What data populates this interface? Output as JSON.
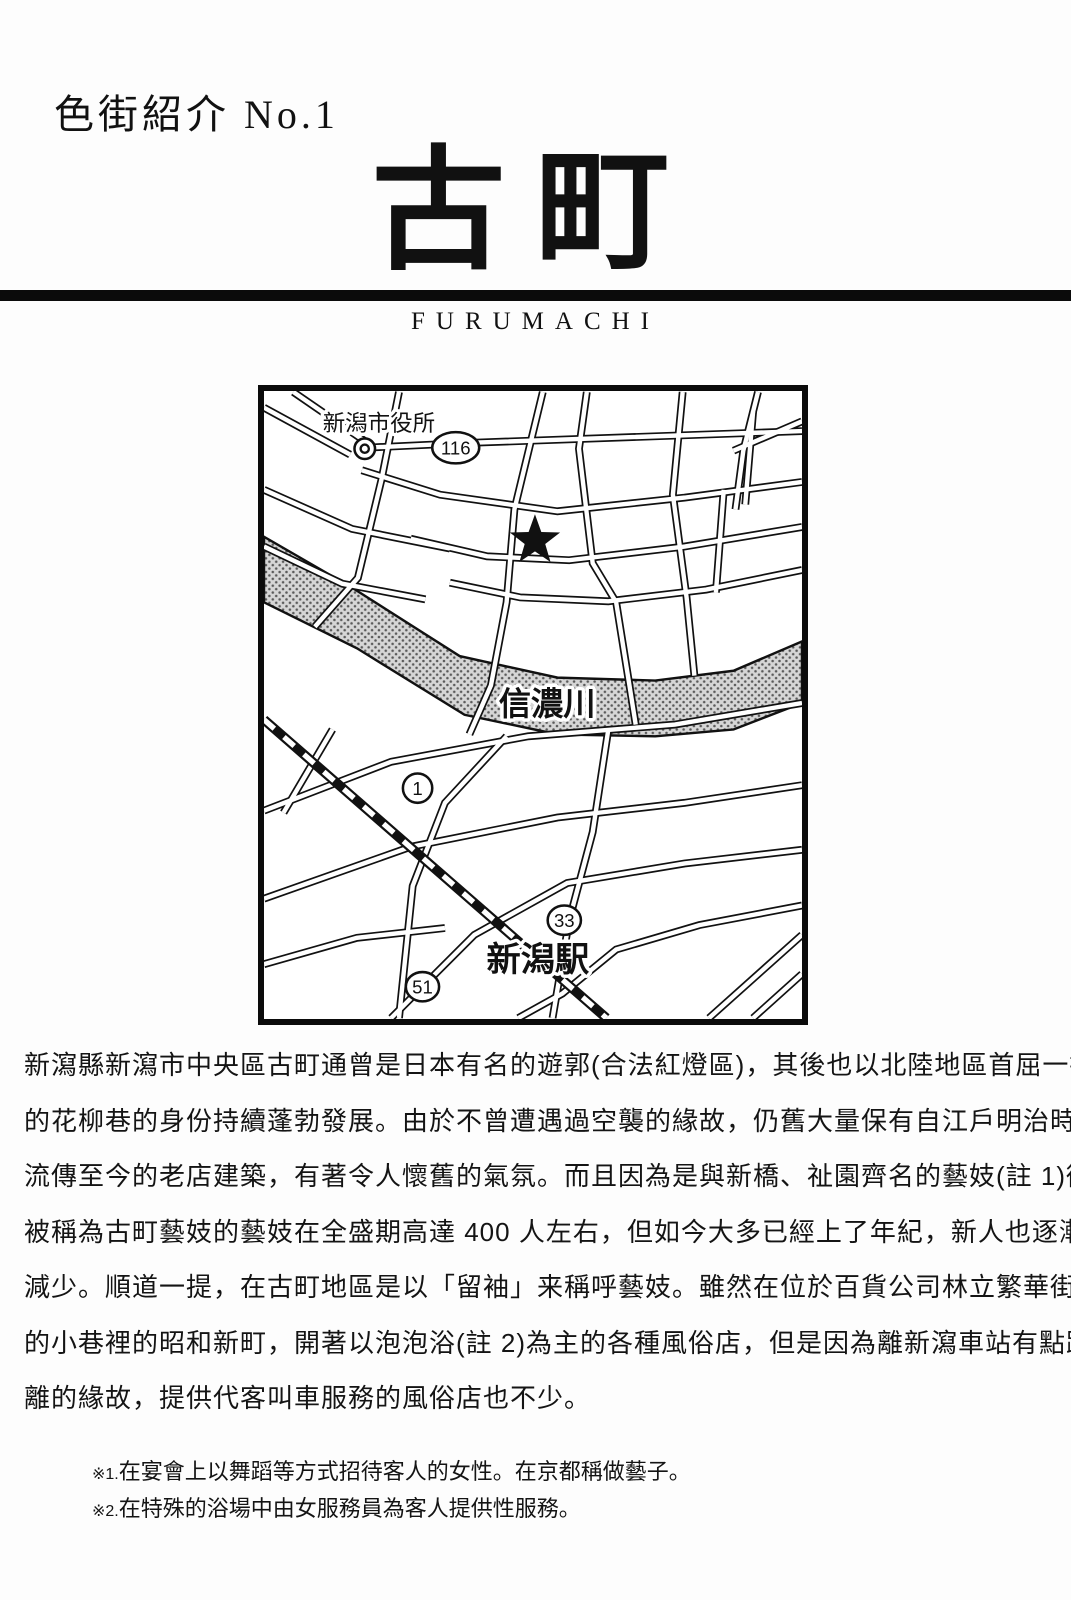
{
  "page": {
    "series_label": "色街紹介 No.1",
    "title": "古町",
    "title_romaji": "FURUMACHI"
  },
  "map": {
    "labels": {
      "city_hall": "新潟市役所",
      "river": "信濃川",
      "station": "新潟駅"
    },
    "badges": [
      {
        "number": "116"
      },
      {
        "number": "1"
      },
      {
        "number": "33"
      },
      {
        "number": "51"
      }
    ],
    "marker": "star"
  },
  "body": {
    "lines": [
      "新瀉縣新瀉市中央區古町通曾是日本有名的遊郭(合法紅燈區)，其後也以北陸地區首屈一指",
      "的花柳巷的身份持續蓬勃發展。由於不曾遭遇過空襲的緣故，仍舊大量保有自江戶明治時代",
      "流傳至今的老店建築，有著令人懷舊的氣氛。而且因為是與新橋、祉園齊名的藝妓(註 1)街，",
      "被稱為古町藝妓的藝妓在全盛期高達 400 人左右，但如今大多已經上了年紀，新人也逐漸",
      "減少。順道一提，在古町地區是以「留袖」来稱呼藝妓。雖然在位於百貨公司林立繁華街道",
      "的小巷裡的昭和新町，開著以泡泡浴(註 2)為主的各種風俗店，但是因為離新瀉車站有點距",
      "離的緣故，提供代客叫車服務的風俗店也不少。"
    ]
  },
  "footnotes": [
    {
      "marker": "※1.",
      "text": "在宴會上以舞蹈等方式招待客人的女性。在京都稱做藝子。"
    },
    {
      "marker": "※2.",
      "text": "在特殊的浴場中由女服務員為客人提供性服務。"
    }
  ],
  "colors": {
    "ink": "#111111",
    "paper": "#fdfdfd",
    "river_halftone": "#d6d6d6"
  }
}
